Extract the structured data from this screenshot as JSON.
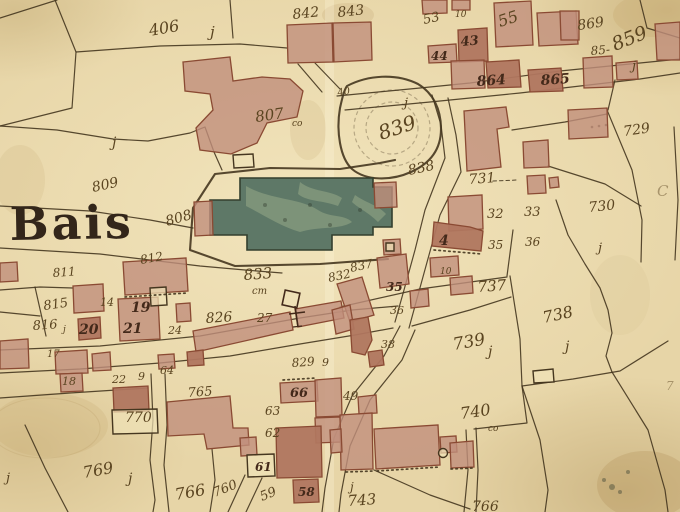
{
  "map": {
    "place_label": "Bais",
    "colors": {
      "paper": "#e7d5a7",
      "paper_light": "#f0e2b8",
      "ink": "#5a4420",
      "inkdark": "#43291a",
      "line": "#45361f",
      "building_fill": "#c18f7c",
      "building_dark": "#b0765f",
      "building_stroke": "#8a4a33",
      "church_fill": "#5e7867",
      "church_stroke": "#333f2e",
      "title_ink": "#33261a"
    },
    "symbols": [
      {
        "name": "calvary-cross",
        "x": 292,
        "y": 300
      },
      {
        "name": "well-circle",
        "x": 443,
        "y": 453
      }
    ],
    "labels": [
      {
        "t": "Bais",
        "x": 10,
        "y": 240,
        "s": 46,
        "r": -1,
        "c": "title",
        "n": "place-title"
      },
      {
        "t": "406",
        "x": 150,
        "y": 36,
        "s": 16,
        "r": -10
      },
      {
        "t": "j",
        "x": 210,
        "y": 37,
        "s": 15
      },
      {
        "t": "842",
        "x": 293,
        "y": 19,
        "s": 14,
        "r": -6
      },
      {
        "t": "843",
        "x": 338,
        "y": 17,
        "s": 14,
        "r": -6
      },
      {
        "t": "53",
        "x": 424,
        "y": 24,
        "s": 13,
        "r": -12
      },
      {
        "t": "10",
        "x": 455,
        "y": 17,
        "s": 9
      },
      {
        "t": "55",
        "x": 500,
        "y": 27,
        "s": 16,
        "r": -18
      },
      {
        "t": "869",
        "x": 578,
        "y": 30,
        "s": 14,
        "r": -8
      },
      {
        "t": "859",
        "x": 615,
        "y": 51,
        "s": 19,
        "r": -22
      },
      {
        "t": "85-",
        "x": 591,
        "y": 55,
        "s": 12,
        "r": -5
      },
      {
        "t": "j",
        "x": 632,
        "y": 70,
        "s": 13
      },
      {
        "t": "43",
        "x": 461,
        "y": 46,
        "s": 13,
        "r": -5,
        "c": "dark"
      },
      {
        "t": "44",
        "x": 431,
        "y": 60,
        "s": 12,
        "c": "dark"
      },
      {
        "t": "864",
        "x": 477,
        "y": 86,
        "s": 14,
        "r": -4,
        "c": "dark"
      },
      {
        "t": "865",
        "x": 541,
        "y": 85,
        "s": 14,
        "r": -4,
        "c": "dark"
      },
      {
        "t": "807",
        "x": 256,
        "y": 122,
        "s": 15,
        "r": -8
      },
      {
        "t": "co",
        "x": 292,
        "y": 126,
        "s": 9
      },
      {
        "t": "40",
        "x": 338,
        "y": 96,
        "s": 10,
        "r": -10
      },
      {
        "t": "j",
        "x": 404,
        "y": 107,
        "s": 13
      },
      {
        "t": "839",
        "x": 381,
        "y": 140,
        "s": 20,
        "r": -18
      },
      {
        "t": "838",
        "x": 409,
        "y": 175,
        "s": 14,
        "r": -12
      },
      {
        "t": "729",
        "x": 624,
        "y": 136,
        "s": 14,
        "r": -8
      },
      {
        "t": "809",
        "x": 93,
        "y": 192,
        "s": 14,
        "r": -12
      },
      {
        "t": "808",
        "x": 167,
        "y": 226,
        "s": 14,
        "r": -16
      },
      {
        "t": "731",
        "x": 469,
        "y": 184,
        "s": 14,
        "r": -4
      },
      {
        "t": "32",
        "x": 487,
        "y": 218,
        "s": 13
      },
      {
        "t": "33",
        "x": 524,
        "y": 216,
        "s": 13
      },
      {
        "t": "730",
        "x": 589,
        "y": 212,
        "s": 14,
        "r": -6
      },
      {
        "t": "j",
        "x": 598,
        "y": 252,
        "s": 13
      },
      {
        "t": "C",
        "x": 657,
        "y": 196,
        "s": 15,
        "c": "faint"
      },
      {
        "t": "4",
        "x": 439,
        "y": 245,
        "s": 14,
        "c": "dark"
      },
      {
        "t": "35",
        "x": 488,
        "y": 249,
        "s": 12
      },
      {
        "t": "36",
        "x": 525,
        "y": 246,
        "s": 12
      },
      {
        "t": "10",
        "x": 440,
        "y": 274,
        "s": 9
      },
      {
        "t": "737",
        "x": 478,
        "y": 292,
        "s": 15,
        "r": -4
      },
      {
        "t": "812",
        "x": 141,
        "y": 264,
        "s": 12,
        "r": -10
      },
      {
        "t": "811",
        "x": 53,
        "y": 277,
        "s": 12,
        "r": -4
      },
      {
        "t": "833",
        "x": 244,
        "y": 280,
        "s": 15,
        "r": -4
      },
      {
        "t": "cm",
        "x": 252,
        "y": 294,
        "s": 10
      },
      {
        "t": "832",
        "x": 329,
        "y": 282,
        "s": 12,
        "r": -12
      },
      {
        "t": "837",
        "x": 351,
        "y": 272,
        "s": 12,
        "r": -12
      },
      {
        "t": "35",
        "x": 386,
        "y": 291,
        "s": 12,
        "c": "dark"
      },
      {
        "t": "36",
        "x": 390,
        "y": 314,
        "s": 11
      },
      {
        "t": "38",
        "x": 381,
        "y": 348,
        "s": 11
      },
      {
        "t": "739",
        "x": 454,
        "y": 350,
        "s": 17,
        "r": -10
      },
      {
        "t": "j",
        "x": 488,
        "y": 356,
        "s": 14
      },
      {
        "t": "738",
        "x": 544,
        "y": 323,
        "s": 16,
        "r": -12
      },
      {
        "t": "j",
        "x": 565,
        "y": 351,
        "s": 14
      },
      {
        "t": "815",
        "x": 44,
        "y": 310,
        "s": 13,
        "r": -8
      },
      {
        "t": "816",
        "x": 33,
        "y": 330,
        "s": 13,
        "r": -4
      },
      {
        "t": "j",
        "x": 63,
        "y": 332,
        "s": 9
      },
      {
        "t": "14",
        "x": 100,
        "y": 306,
        "s": 11
      },
      {
        "t": "19",
        "x": 131,
        "y": 312,
        "s": 14,
        "c": "dark"
      },
      {
        "t": "20",
        "x": 79,
        "y": 334,
        "s": 14,
        "c": "dark"
      },
      {
        "t": "21",
        "x": 123,
        "y": 333,
        "s": 14,
        "c": "dark"
      },
      {
        "t": "24",
        "x": 168,
        "y": 334,
        "s": 11
      },
      {
        "t": "826",
        "x": 206,
        "y": 323,
        "s": 14,
        "r": -4
      },
      {
        "t": "27",
        "x": 257,
        "y": 322,
        "s": 12
      },
      {
        "t": "17",
        "x": 47,
        "y": 357,
        "s": 10
      },
      {
        "t": "18",
        "x": 62,
        "y": 385,
        "s": 11
      },
      {
        "t": "22",
        "x": 112,
        "y": 383,
        "s": 11
      },
      {
        "t": "9",
        "x": 138,
        "y": 380,
        "s": 11
      },
      {
        "t": "64",
        "x": 160,
        "y": 374,
        "s": 11
      },
      {
        "t": "829",
        "x": 292,
        "y": 367,
        "s": 12,
        "r": -4
      },
      {
        "t": "9",
        "x": 322,
        "y": 366,
        "s": 11
      },
      {
        "t": "765",
        "x": 188,
        "y": 397,
        "s": 13,
        "r": -4
      },
      {
        "t": "66",
        "x": 290,
        "y": 397,
        "s": 13,
        "c": "dark"
      },
      {
        "t": "770",
        "x": 125,
        "y": 422,
        "s": 14
      },
      {
        "t": "63",
        "x": 265,
        "y": 415,
        "s": 12
      },
      {
        "t": "62",
        "x": 265,
        "y": 437,
        "s": 12
      },
      {
        "t": "49",
        "x": 343,
        "y": 400,
        "s": 12
      },
      {
        "t": "61",
        "x": 255,
        "y": 471,
        "s": 12,
        "c": "dark"
      },
      {
        "t": "760",
        "x": 215,
        "y": 497,
        "s": 13,
        "r": -22
      },
      {
        "t": "59",
        "x": 262,
        "y": 501,
        "s": 13,
        "r": -22
      },
      {
        "t": "58",
        "x": 298,
        "y": 496,
        "s": 12,
        "c": "dark"
      },
      {
        "t": "769",
        "x": 84,
        "y": 478,
        "s": 16,
        "r": -10
      },
      {
        "t": "j",
        "x": 128,
        "y": 483,
        "s": 14
      },
      {
        "t": "766",
        "x": 176,
        "y": 500,
        "s": 16,
        "r": -10
      },
      {
        "t": "j",
        "x": 6,
        "y": 482,
        "s": 13
      },
      {
        "t": "743",
        "x": 348,
        "y": 506,
        "s": 15,
        "r": -4
      },
      {
        "t": "j",
        "x": 350,
        "y": 491,
        "s": 12
      },
      {
        "t": "740",
        "x": 461,
        "y": 419,
        "s": 16,
        "r": -8
      },
      {
        "t": "co",
        "x": 488,
        "y": 431,
        "s": 9
      },
      {
        "t": "766",
        "x": 472,
        "y": 511,
        "s": 14
      },
      {
        "t": "7",
        "x": 666,
        "y": 390,
        "s": 12,
        "c": "faint"
      },
      {
        "t": "j",
        "x": 112,
        "y": 147,
        "s": 14
      }
    ]
  }
}
